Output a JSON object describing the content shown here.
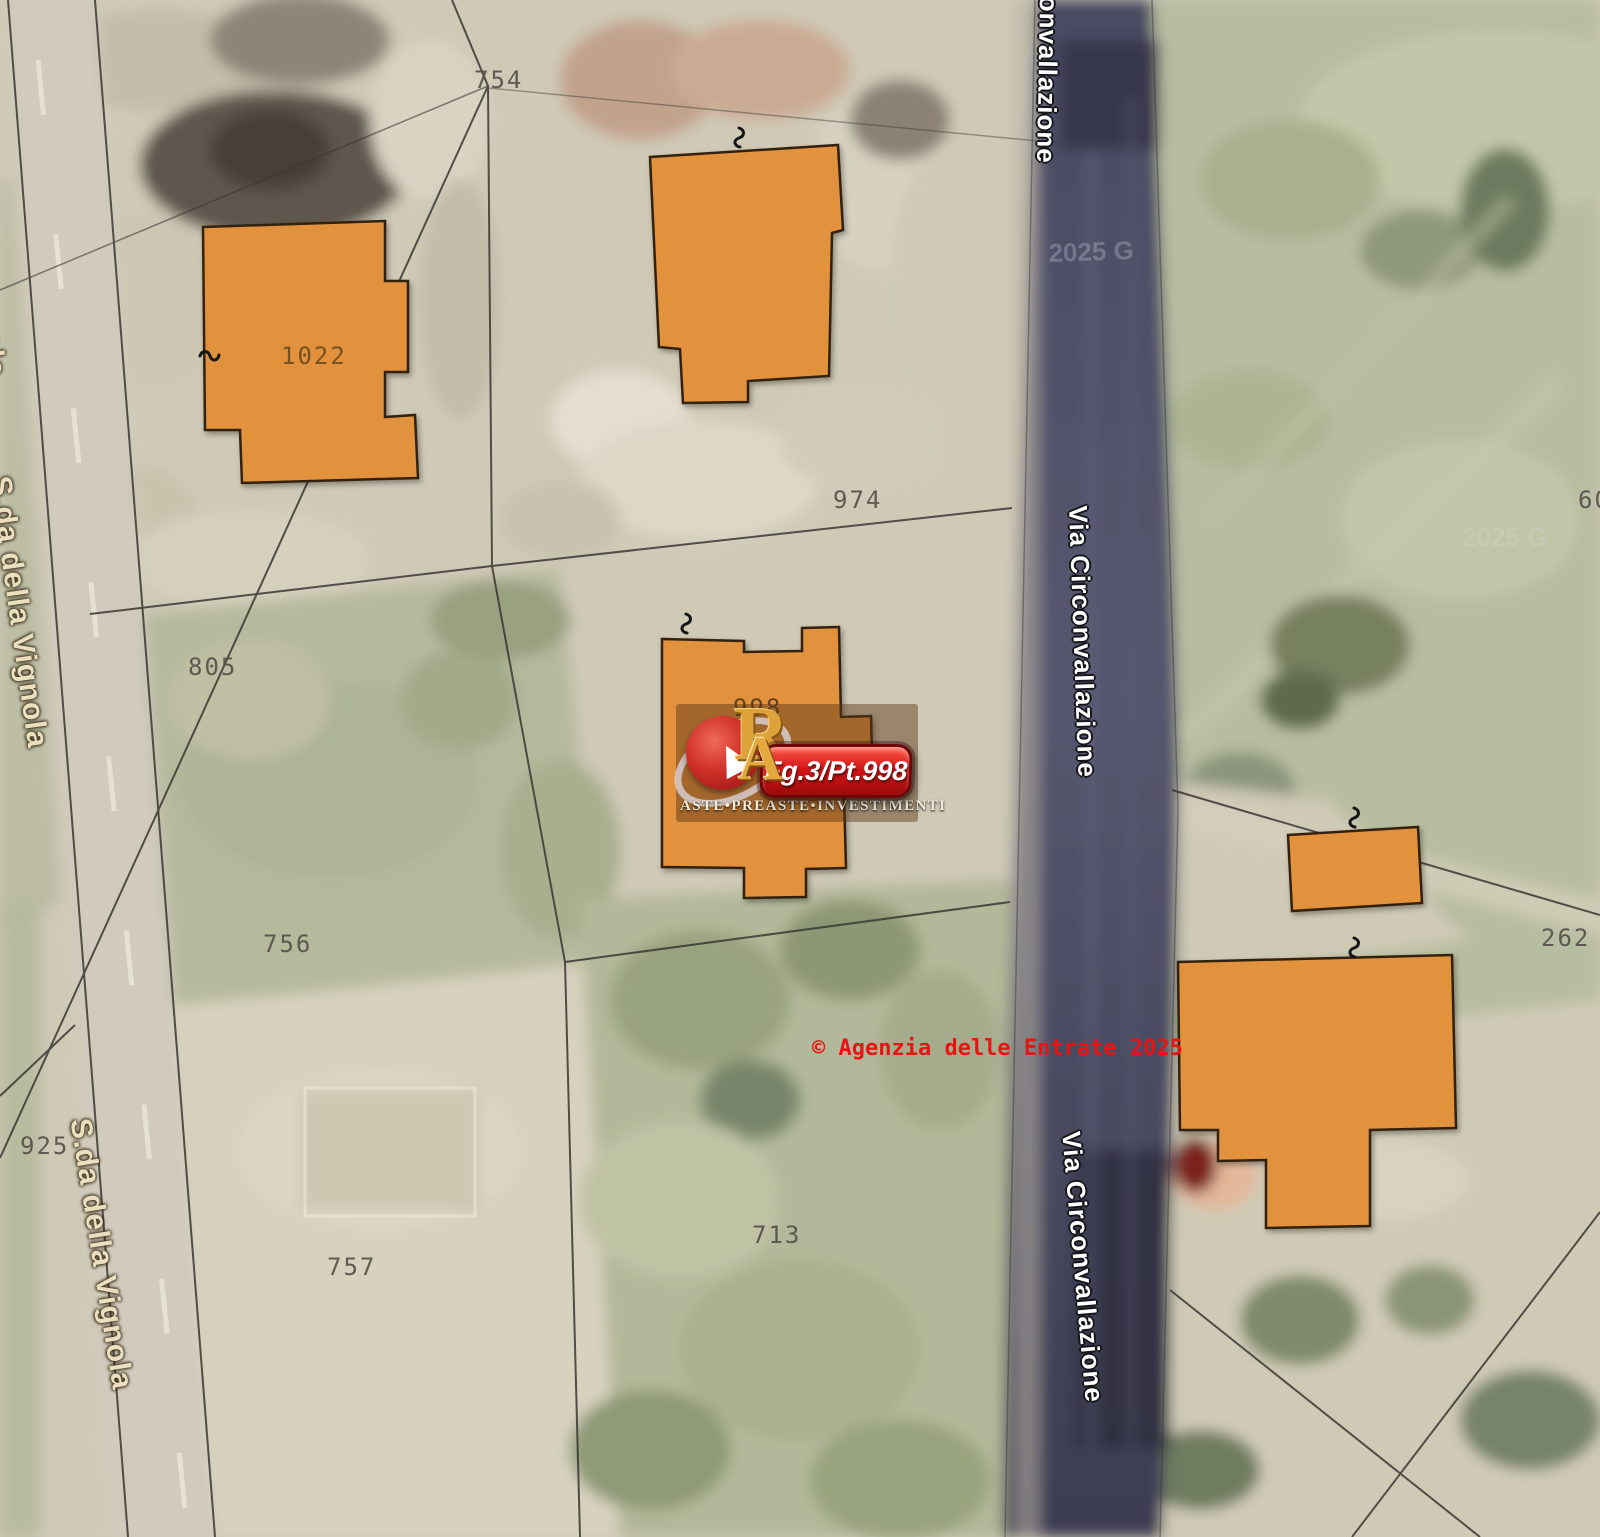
{
  "map": {
    "streets": {
      "circonvallazione_top": "onvallazione",
      "circonvallazione_mid": "Via Circonvallazione",
      "circonvallazione_bottom": "Via Circonvallazione",
      "vignola_top": "S.da della Vignola",
      "vignola_mid": "S.da della Vignola",
      "vignola_bottom": "S.da della Vignola"
    },
    "parcels": {
      "p754": "754",
      "p974": "974",
      "p1022": "1022",
      "p805": "805",
      "p756": "756",
      "p925": "925",
      "p757": "757",
      "p713": "713",
      "p262": "262",
      "p60": "60",
      "p998": "998"
    },
    "copyright": "© Agenzia delle Entrate 2025",
    "faint_watermark": "2025 G",
    "logo": {
      "monogram_r": "R",
      "monogram_a": "A",
      "badge": "Fg.3/Pt.998",
      "brand": "ASTE•PREASTE•INVESTIMENTI"
    },
    "colors": {
      "building_fill": "#e2913c",
      "building_stroke": "#33200a",
      "road": "#50516a",
      "copyright_red": "#e81414",
      "circonvallazione_label": "#ffffff",
      "vignola_label": "#eadfbe"
    }
  }
}
